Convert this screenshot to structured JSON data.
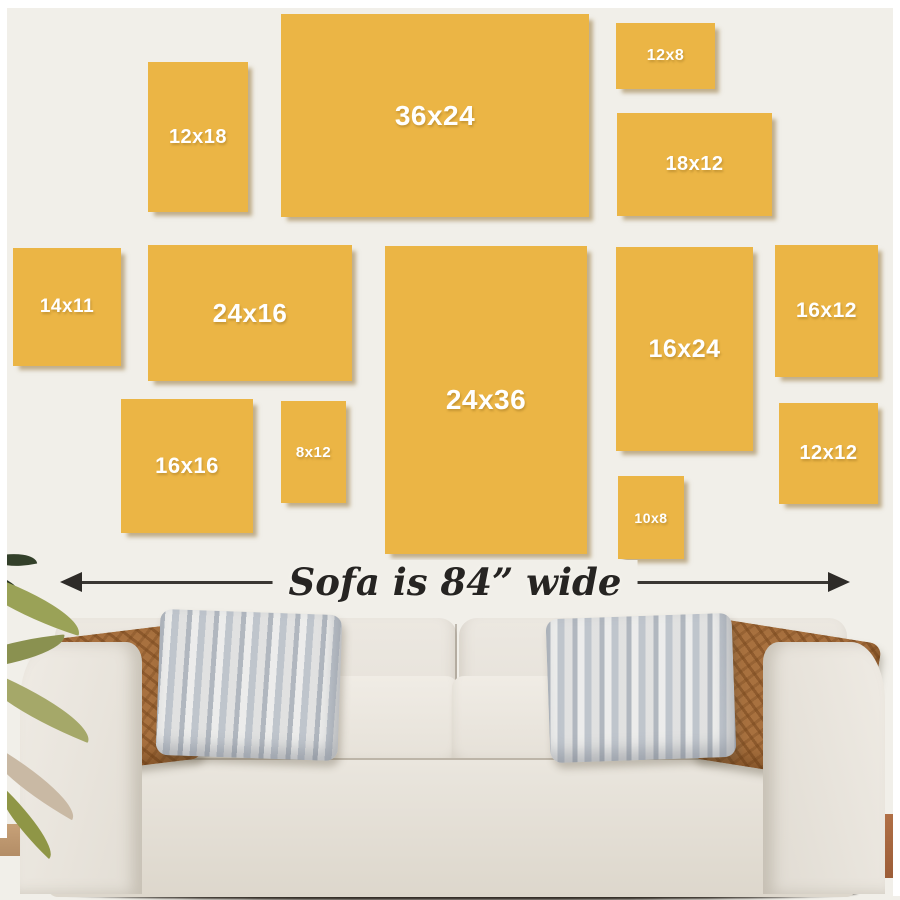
{
  "scene": {
    "background_color": "#f1efe9",
    "frame_color": "#ebb545",
    "frame_label_color": "#ffffff",
    "arrow_color": "#2e2b28"
  },
  "frames": [
    {
      "label": "12x18",
      "x": 148,
      "y": 62,
      "w": 100,
      "h": 150,
      "fs": 20
    },
    {
      "label": "36x24",
      "x": 281,
      "y": 14,
      "w": 308,
      "h": 203,
      "fs": 28
    },
    {
      "label": "12x8",
      "x": 616,
      "y": 23,
      "w": 99,
      "h": 66,
      "fs": 16
    },
    {
      "label": "18x12",
      "x": 617,
      "y": 113,
      "w": 155,
      "h": 103,
      "fs": 20
    },
    {
      "label": "14x11",
      "x": 13,
      "y": 248,
      "w": 108,
      "h": 118,
      "fs": 19
    },
    {
      "label": "24x16",
      "x": 148,
      "y": 245,
      "w": 204,
      "h": 136,
      "fs": 26
    },
    {
      "label": "24x36",
      "x": 385,
      "y": 246,
      "w": 202,
      "h": 308,
      "fs": 28
    },
    {
      "label": "16x24",
      "x": 616,
      "y": 247,
      "w": 137,
      "h": 204,
      "fs": 25
    },
    {
      "label": "16x12",
      "x": 775,
      "y": 245,
      "w": 103,
      "h": 132,
      "fs": 21
    },
    {
      "label": "16x16",
      "x": 121,
      "y": 399,
      "w": 132,
      "h": 134,
      "fs": 22
    },
    {
      "label": "8x12",
      "x": 281,
      "y": 401,
      "w": 65,
      "h": 102,
      "fs": 15
    },
    {
      "label": "10x8",
      "x": 618,
      "y": 476,
      "w": 66,
      "h": 83,
      "fs": 14
    },
    {
      "label": "12x12",
      "x": 779,
      "y": 403,
      "w": 99,
      "h": 101,
      "fs": 20
    }
  ],
  "dimension": {
    "label": "Sofa is 84” wide"
  }
}
